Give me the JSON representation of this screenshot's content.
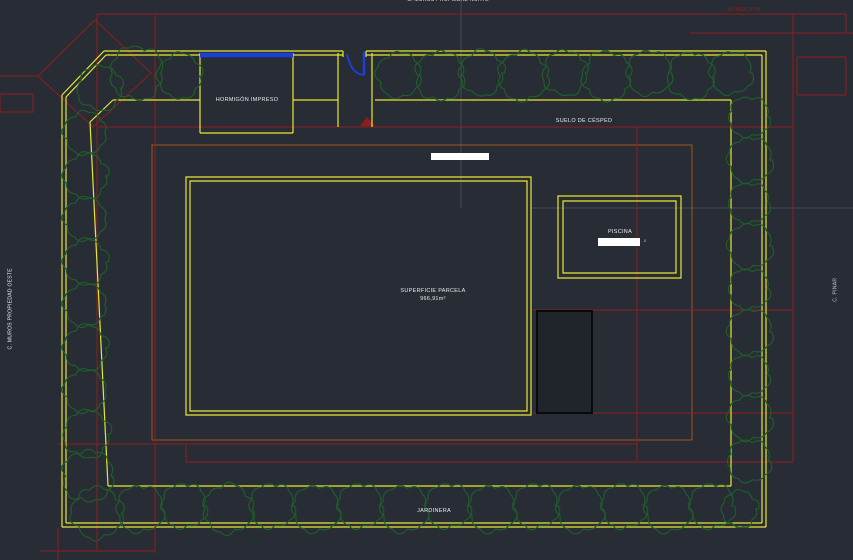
{
  "viewport": {
    "background": "#282d35"
  },
  "labels": {
    "street_top": "C. MUROS PROPIEDAD NORTE",
    "street_left": "C. MUROS PROPIEDAD OESTE",
    "street_right": "C. PINAR",
    "setback_note": "ALINEACIÓN",
    "concrete_area": "HORMIGÓN IMPRESO",
    "grass_area": "SUELO DE CÉSPED",
    "parcel_area_title": "SUPERFICIE PARCELA",
    "parcel_area_value": "966,91m²",
    "pool": "PISCINA",
    "pool_area_suffix": "²",
    "planter": "JARDINERA"
  },
  "colors": {
    "bg": "#282d35",
    "boundary_yellow": "#e8e636",
    "setback_red": "#8f1d1d",
    "setback_orange": "#a5551e",
    "vegetation_green": "#1e5f29",
    "gate_blue": "#1b3fd8",
    "text_white": "#e8eaec"
  }
}
